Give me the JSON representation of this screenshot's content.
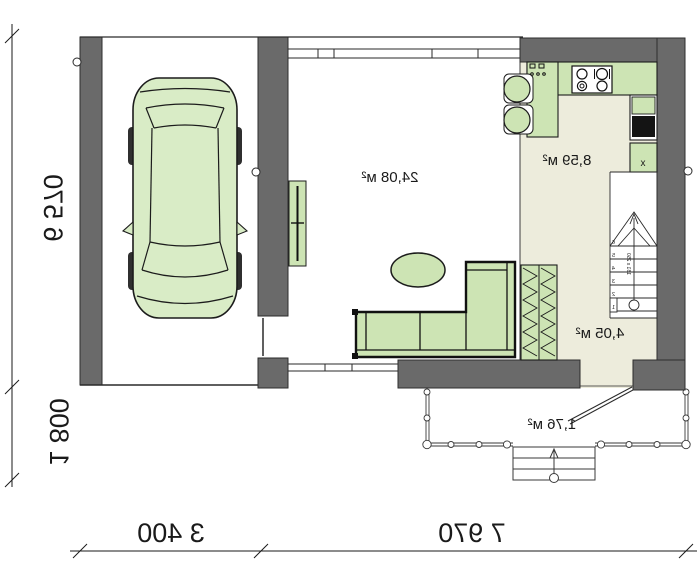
{
  "plan": {
    "type": "floor-plan",
    "mirrored": true,
    "rooms": {
      "living": {
        "name": "living-room",
        "area": "24,08 м²"
      },
      "kitchen": {
        "name": "kitchen",
        "area": "8,59 м²"
      },
      "hall": {
        "name": "hall",
        "area": "4,05 м²"
      },
      "porch": {
        "name": "porch",
        "area": "1,76 м²"
      }
    },
    "dimensions": {
      "height_total": "6 570",
      "porch_depth": "1 800",
      "garage_width": "3 400",
      "house_width": "7 970"
    },
    "stairs": {
      "note": "181 x 250",
      "steps": [
        "1",
        "2",
        "3",
        "4",
        "5",
        "6"
      ]
    },
    "fixtures": {
      "washer_mark": "x"
    },
    "colors": {
      "wall_gray": "#6a6a6a",
      "furniture_green": "#cde4b4",
      "car_green": "#d9ecc6",
      "floor_beige": "#edecdc",
      "line_black": "#1a1a1a"
    }
  }
}
